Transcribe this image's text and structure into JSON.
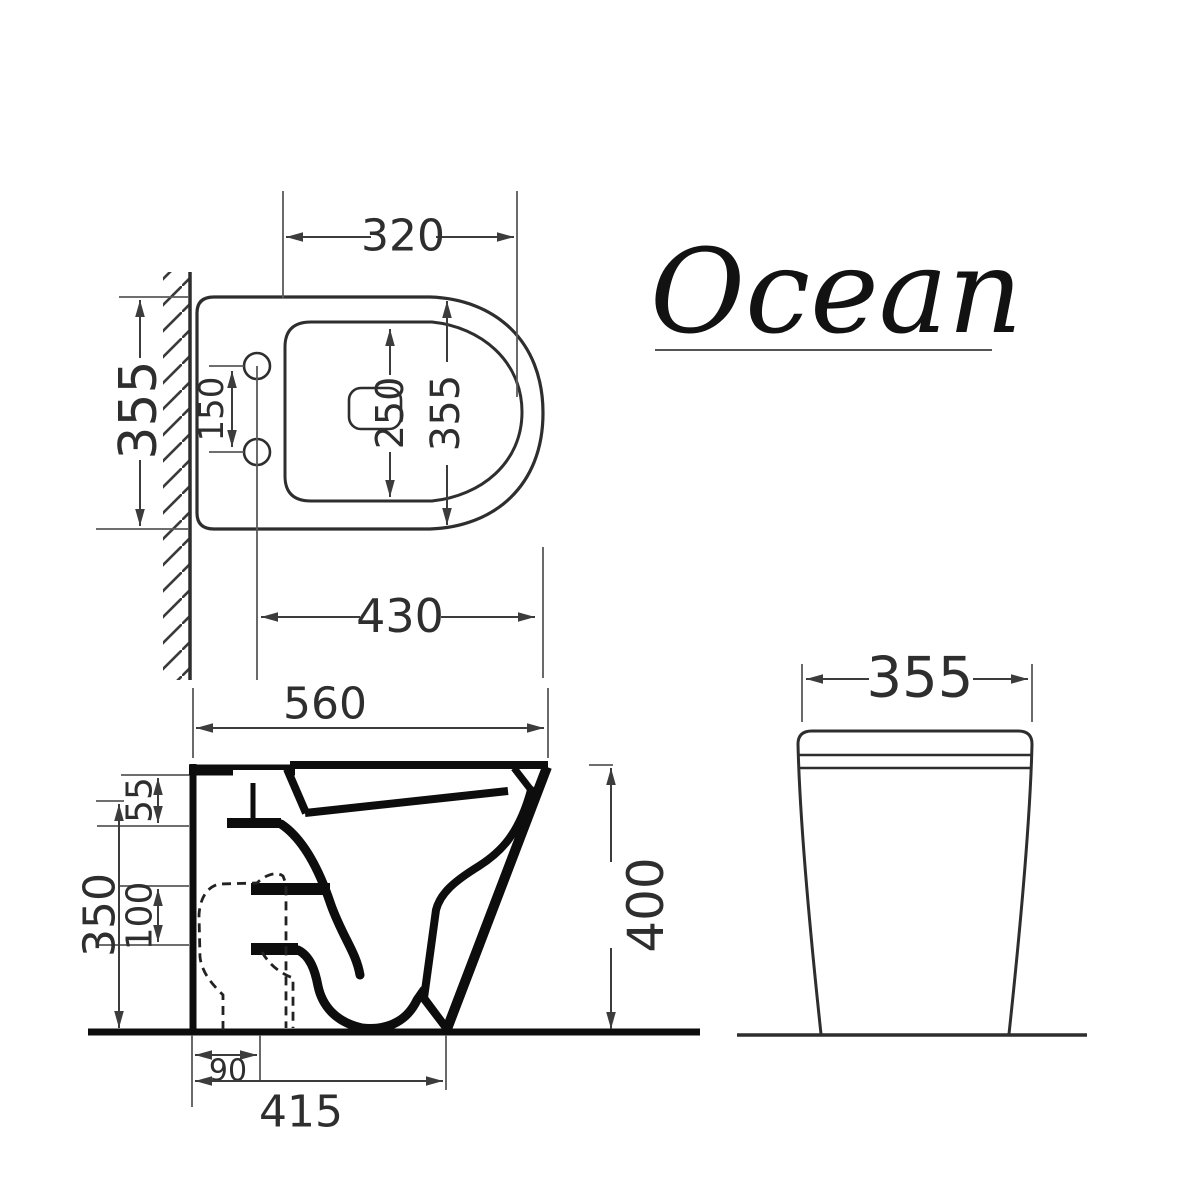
{
  "title": "Ocean",
  "plan_view": {
    "dims": {
      "top_width": "320",
      "side_depth": "355",
      "hole_spacing": "150",
      "bowl_length": "250",
      "seat_depth": "355",
      "front_reach": "430"
    }
  },
  "side_view": {
    "dims": {
      "overall_depth": "560",
      "rim_section": "55",
      "inlet_gap": "100",
      "inlet_height": "350",
      "overall_height": "400",
      "outlet_offset": "90",
      "base_depth": "415"
    }
  },
  "front_view": {
    "dims": {
      "overall_width": "355"
    }
  },
  "colors": {
    "line": "#0d0d0d",
    "dimension": "#3c3c3c",
    "text": "#2e2e2e",
    "background": "#ffffff"
  }
}
